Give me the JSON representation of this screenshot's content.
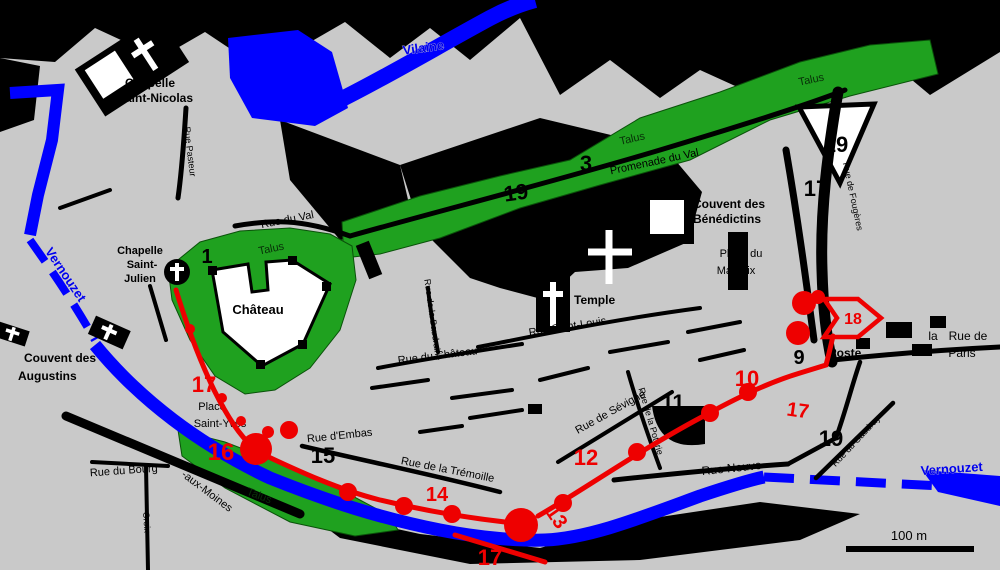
{
  "rivers": {
    "vilaine": "Vilaine",
    "vernouzet_left": "Vernouzet",
    "vernouzet_right": "Vernouzet"
  },
  "labels": {
    "chapelle_st_nicolas_l1": "Chapelle",
    "chapelle_st_nicolas_l2": "Saint-Nicolas",
    "rue_pasteur": "Rue Pasteur",
    "rue_du_val": "Rue du Val",
    "talus_1": "Talus",
    "talus_2": "Talus",
    "talus_3": "Talus",
    "talus_4": "Talus",
    "promenade_du_val": "Promenade du Val",
    "couvent_benedictins_l1": "Couvent des",
    "couvent_benedictins_l2": "Bénédictins",
    "place_marchix_l1": "Place du",
    "place_marchix_l2": "Marchix",
    "chapelle_st_julien_l1": "Chapelle",
    "chapelle_st_julien_l2": "Saint-",
    "chapelle_st_julien_l3": "Julien",
    "chateau": "Château",
    "couvent_augustins_l1": "Couvent des",
    "couvent_augustins_l2": "Augustins",
    "temple": "Temple",
    "rue_st_louis": "Rue Saint-Louis",
    "rue_du_chateau": "Rue du Château",
    "rue_baudrairie": "Rue de la Baudrairie",
    "rue_poterie": "Rue de la Poterie",
    "rue_sevigne": "Rue de Sévigné",
    "rue_dembas": "Rue d'Embas",
    "place_st_yves_l1": "Place",
    "place_st_yves_l2": "Saint-Yves",
    "rue_bourg": "Rue du Bourg",
    "rue_aux_moines": "-aux-Moines",
    "rue_tremoille": "Rue de la Trémoille",
    "rue_neuve": "Rue Neuve",
    "rue_gaudray": "Rue du Gaudray",
    "rue_fougeres": "Rue de Fougères",
    "rue_croix": "Croix",
    "rue_de_paris_l1": "Rue de",
    "rue_de_paris_l2": "Paris",
    "fragment_la": "la",
    "poste": "Poste"
  },
  "numbers": {
    "n1": "1",
    "n3": "3",
    "n9": "9",
    "n10": "10",
    "n11": "11",
    "n12": "12",
    "n13": "13",
    "n14": "14",
    "n15": "15",
    "n16": "16",
    "n18": "18",
    "n17_west": "17",
    "n17_east": "17",
    "n17_south": "17",
    "n17_ne": "17",
    "n19_green": "19",
    "n19_ne": "19",
    "n19_se": "19"
  },
  "scale": {
    "label": "100 m"
  },
  "colors": {
    "background": "#c9c9c9",
    "water": "#0000ff",
    "talus_green": "#1fa11f",
    "wall_red": "#ee0000",
    "roads": "#000000"
  }
}
